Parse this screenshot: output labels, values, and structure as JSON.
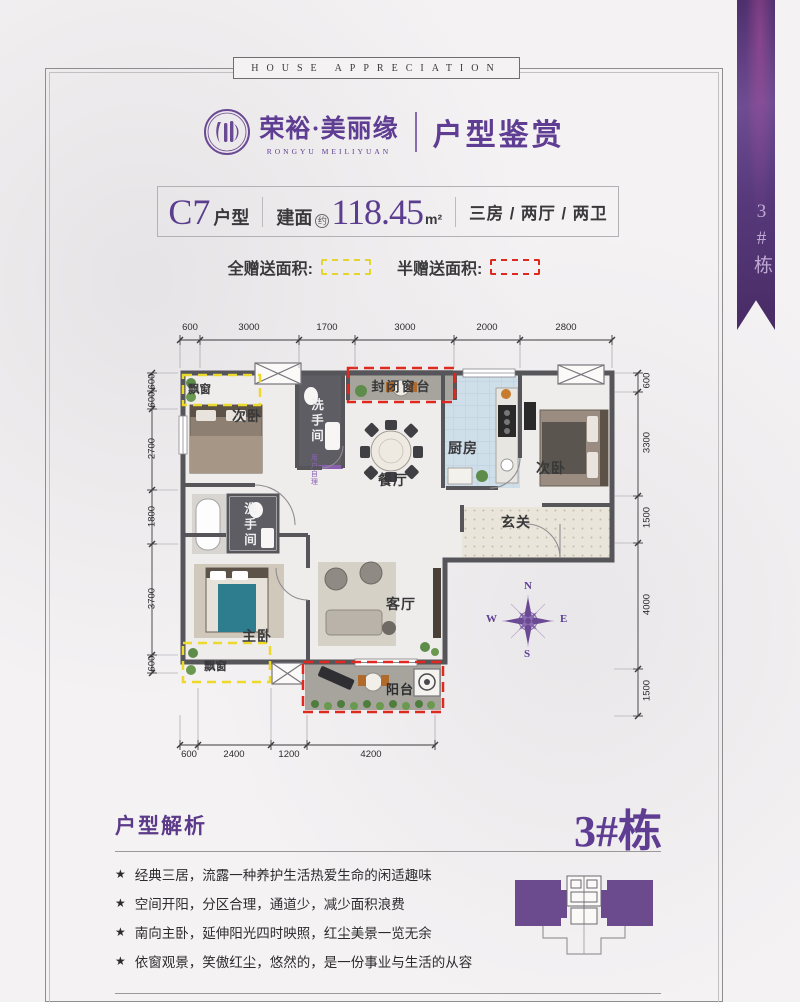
{
  "banner": {
    "text": "HOUSE APPRECIATION"
  },
  "logo": {
    "brand_cn": "荣裕·美丽缘",
    "brand_en": "RONGYU MEILIYUAN",
    "section_title": "户型鉴赏"
  },
  "ribbon": {
    "label": "3#栋"
  },
  "info_bar": {
    "unit_code": "C7",
    "unit_suffix": "户型",
    "area_prefix": "建面",
    "area_circle": "约",
    "area_value": "118.45",
    "area_unit": "m²",
    "room_config": "三房 / 两厅 / 两卫"
  },
  "legend": {
    "full_gift": "全赠送面积:",
    "half_gift": "半赠送面积:"
  },
  "floor_plan": {
    "rooms": {
      "bay_window_top": "飘窗",
      "bedroom_left": "次卧",
      "bathroom_top": "洗手间",
      "enclosed_sill": "封闭窗台",
      "dining": "餐厅",
      "kitchen": "厨房",
      "bedroom_right": "次卧",
      "foyer": "玄关",
      "bathroom_left": "洗手间",
      "master_bedroom": "主卧",
      "living": "客厅",
      "balcony": "阳台",
      "bay_window_bottom": "飘窗",
      "note": "用户自理"
    },
    "dims": {
      "top": [
        "600",
        "3000",
        "1700",
        "3000",
        "2000",
        "2800"
      ],
      "bottom": [
        "600",
        "2400",
        "1200",
        "4200"
      ],
      "left": [
        "600",
        "600",
        "2700",
        "1800",
        "3700",
        "600"
      ],
      "right": [
        "600",
        "3300",
        "1500",
        "4000",
        "1500"
      ]
    },
    "compass": {
      "n": "N",
      "e": "E",
      "s": "S",
      "w": "W"
    }
  },
  "analysis": {
    "title": "户型解析",
    "building_label": "3#栋",
    "bullet": "★",
    "points": [
      "经典三居，流露一种养护生活热爱生命的闲适趣味",
      "空间开阳，分区合理，通道少，减少面积浪费",
      "南向主卧，延伸阳光四时映照，红尘美景一览无余",
      "依窗观景，笑傲红尘，悠然的，是一份事业与生活的从容"
    ]
  },
  "colors": {
    "brand_purple": "#5e3d92",
    "gift_full_yellow": "#e3d42f",
    "gift_half_red": "#de2a1e",
    "wall_gray": "#55555a"
  }
}
